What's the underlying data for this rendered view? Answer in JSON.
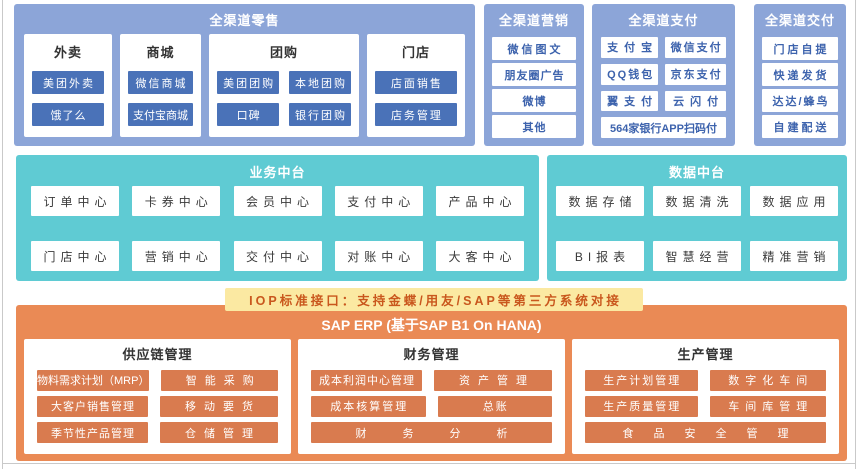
{
  "palette": {
    "blue_container": "#8CA5D8",
    "blue_chip": "#4A72B8",
    "blue_chip_text": "#3D63AD",
    "teal_container": "#5FCBD3",
    "yellow_bar": "#FBE9A2",
    "iop_text": "#C9571D",
    "orange_container": "#EA8A55",
    "orange_chip": "#D97B4F",
    "dark_text": "#333333"
  },
  "retail": {
    "title": "全渠道零售",
    "columns": [
      {
        "title": "外卖",
        "chips": [
          "美团外卖",
          "饿了么"
        ]
      },
      {
        "title": "商城",
        "chips": [
          "微信商城",
          "支付宝商城"
        ]
      },
      {
        "title": "团购",
        "chips": [
          "美团团购",
          "本地团购",
          "口碑",
          "银行团购"
        ]
      },
      {
        "title": "门店",
        "chips": [
          "店面销售",
          "店务管理"
        ]
      }
    ]
  },
  "marketing": {
    "title": "全渠道营销",
    "chips": [
      "微信图文",
      "朋友圈广告",
      "微博",
      "其他"
    ]
  },
  "payment": {
    "title": "全渠道支付",
    "chips": [
      "支付宝",
      "微信支付",
      "QQ钱包",
      "京东支付",
      "翼支付",
      "云闪付",
      "564家银行APP扫码付"
    ]
  },
  "delivery": {
    "title": "全渠道交付",
    "chips": [
      "门店自提",
      "快递发货",
      "达达/蜂鸟",
      "自建配送"
    ]
  },
  "business_platform": {
    "title": "业务中台",
    "rows": [
      [
        "订单中心",
        "卡券中心",
        "会员中心",
        "支付中心",
        "产品中心"
      ],
      [
        "门店中心",
        "营销中心",
        "交付中心",
        "对账中心",
        "大客中心"
      ]
    ]
  },
  "data_platform": {
    "title": "数据中台",
    "rows": [
      [
        "数据存储",
        "数据清洗",
        "数据应用"
      ],
      [
        "BI报表",
        "智慧经营",
        "精准营销"
      ]
    ]
  },
  "iop_bar": {
    "label": "IOP标准接口：支持金蝶/用友/SAP等第三方系统对接"
  },
  "erp": {
    "title": "SAP ERP (基于SAP B1 On HANA)",
    "panels": [
      {
        "title": "供应链管理",
        "rows": [
          [
            "物料需求计划（MRP）",
            "智能采购"
          ],
          [
            "大客户销售管理",
            "移动要货"
          ],
          [
            "季节性产品管理",
            "仓储管理"
          ]
        ]
      },
      {
        "title": "财务管理",
        "rows": [
          [
            "成本利润中心管理",
            "资产管理"
          ],
          [
            "成本核算管理",
            "总账"
          ],
          [
            "财务分析"
          ]
        ]
      },
      {
        "title": "生产管理",
        "rows": [
          [
            "生产计划管理",
            "数字化车间"
          ],
          [
            "生产质量管理",
            "车间库管理"
          ],
          [
            "食品安全管理"
          ]
        ]
      }
    ]
  }
}
